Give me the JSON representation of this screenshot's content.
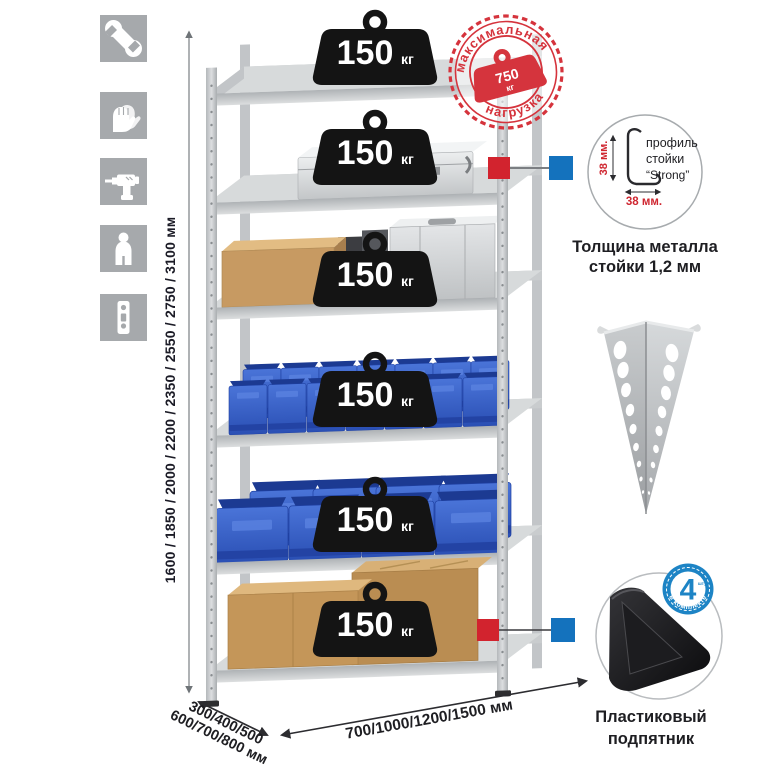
{
  "colors": {
    "icon_gray": "#a6a9ac",
    "stamp_red": "#d5333c",
    "callout_red": "#d2232e",
    "callout_blue": "#1472bd",
    "bin_blue": "#2f55c0",
    "metal_gray": "#c6c9cc",
    "badge_black": "#141414"
  },
  "left_icons": [
    "wrench",
    "gloves",
    "drill",
    "person",
    "perforated-profile"
  ],
  "height_dimension": {
    "label": "1600 / 1850 / 2000 / 2200 / 2350 / 2550 / 2750 / 3100 мм"
  },
  "shelf_badge": {
    "value": "150",
    "unit": "кг",
    "count": 6
  },
  "max_load_stamp": {
    "arc_top": "максимальная",
    "arc_bottom": "нагрузка",
    "value": "750",
    "unit": "кг"
  },
  "profile_detail": {
    "line1": "профиль",
    "line2": "стойки",
    "line3": "“Strong”",
    "dim_vertical": "38 мм.",
    "dim_horizontal": "38 мм.",
    "caption_line1": "Толщина металла",
    "caption_line2": "стойки 1,2 мм"
  },
  "foot_detail": {
    "badge_value": "4",
    "badge_small": "штуки",
    "badge_arc": "в комплекте",
    "caption_line1": "Пластиковый",
    "caption_line2": "подпятник"
  },
  "base_dimensions": {
    "depth_line1": "300/400/500",
    "depth_line2": "600/700/800 мм",
    "width": "700/1000/1200/1500 мм"
  }
}
